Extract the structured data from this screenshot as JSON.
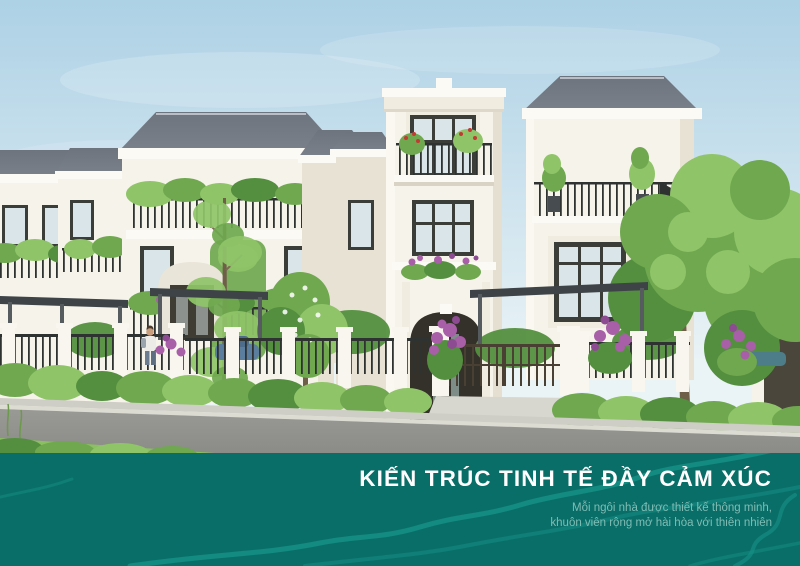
{
  "banner": {
    "title": "KIẾN TRÚC TINH TẾ ĐẦY CẢM XÚC",
    "subtitle_line1": "Mỗi ngôi nhà được thiết kế thông minh,",
    "subtitle_line2": "khuôn viên rộng mở hài hòa với thiên nhiên"
  },
  "colors": {
    "banner_teal": "#0a6e68",
    "contour_line": "#17958a",
    "title_text": "#ffffff",
    "subtitle_text": "#7fbcb4",
    "sky_top": "#add1e5",
    "sky_bottom": "#eaf3f6",
    "villa_white": "#f6f3ea",
    "roof_gray": "#7b818b",
    "foliage_green": "#6fa84f",
    "flower_purple": "#a85fa8",
    "road_gray": "#999995"
  },
  "scene": {
    "label": "Row of white neo-classical three-storey villas with grey hip roofs, planted balconies, iron fences, hedges, purple flowering shrubs and a street in the foreground"
  }
}
